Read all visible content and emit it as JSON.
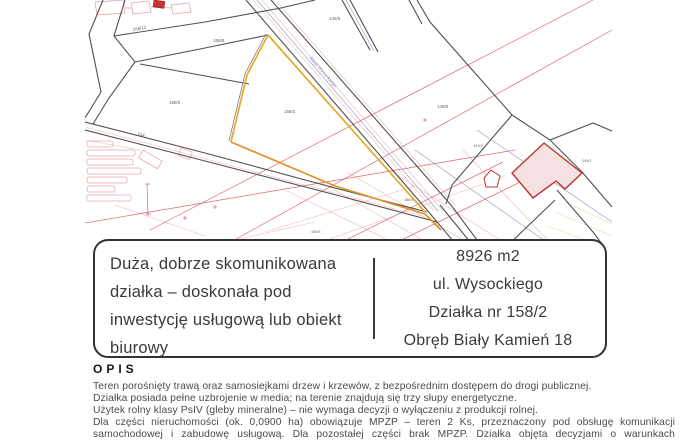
{
  "info_box": {
    "description": "Duża, dobrze skomunikowana działka – doskonała pod inwestycję usługową lub obiekt biurowy",
    "area": "8926 m2",
    "street": "ul. Wysockiego",
    "plot": "Działka nr 158/2",
    "district": "Obręb Biały Kamień 18"
  },
  "opis": {
    "title": "OPIS",
    "paragraphs": [
      "Teren porośnięty trawą oraz samosiejkami drzew i krzewów, z bezpośrednim dostępem do drogi publicznej.",
      "Działka posiada pełne uzbrojenie w media; na terenie znajdują się trzy słupy energetyczne.",
      "Użytek rolny klasy PsIV (gleby mineralne) – nie wymaga decyzji o wyłączeniu z produkcji rolnej.",
      "Dla części nieruchomości (ok. 0,0900 ha) obowiązuje MPZP – teren 2 Ks, przeznaczony pod obsługę komunikacji samochodowej i zabudowę usługową. Dla pozostałej części brak MPZP. Działka objęta decyzjami o warunkach"
    ]
  },
  "map": {
    "street_label": "Aleja Wysockiego",
    "labels": [
      {
        "text": "158/12",
        "x": 48,
        "y": 31,
        "rot": -10,
        "size": 4.5
      },
      {
        "text": "158/8",
        "x": 128,
        "y": 42,
        "rot": 0,
        "size": 4.5
      },
      {
        "text": "158/9",
        "x": 84,
        "y": 104,
        "rot": 0,
        "size": 4.5
      },
      {
        "text": "158/2",
        "x": 199,
        "y": 113,
        "rot": 0,
        "size": 4.5
      },
      {
        "text": "146/5",
        "x": 244,
        "y": 20,
        "rot": 0,
        "size": 4.5
      },
      {
        "text": "149/5",
        "x": 352,
        "y": 108,
        "rot": 0,
        "size": 4.5
      },
      {
        "text": "149/2",
        "x": 388,
        "y": 147,
        "rot": 0,
        "size": 4
      },
      {
        "text": "149/1",
        "x": 497,
        "y": 162,
        "rot": 0,
        "size": 3.8
      },
      {
        "text": "154",
        "x": 52,
        "y": 135,
        "rot": 15,
        "size": 4.5
      },
      {
        "text": "158/1",
        "x": 319,
        "y": 201,
        "rot": 0,
        "size": 3.8
      },
      {
        "text": "160/5",
        "x": 226,
        "y": 233,
        "rot": 0,
        "size": 3.8
      },
      {
        "text": "Aleja Wysockiego",
        "x": 224,
        "y": 58,
        "rot": 49,
        "size": 5,
        "color": "#8d93b5"
      }
    ],
    "colors": {
      "boundary": "#4f4f4f",
      "plot_outline": "#e3aa2b",
      "plot_outline_bottom": "#e1912c",
      "utility_red": "#d96a6a",
      "utility_pink": "#f0b9b9",
      "utility_blue": "#8f97c9",
      "building_fill": "#f5e1e1",
      "building_stroke": "#c03434",
      "label_color": "#6a6258"
    }
  }
}
